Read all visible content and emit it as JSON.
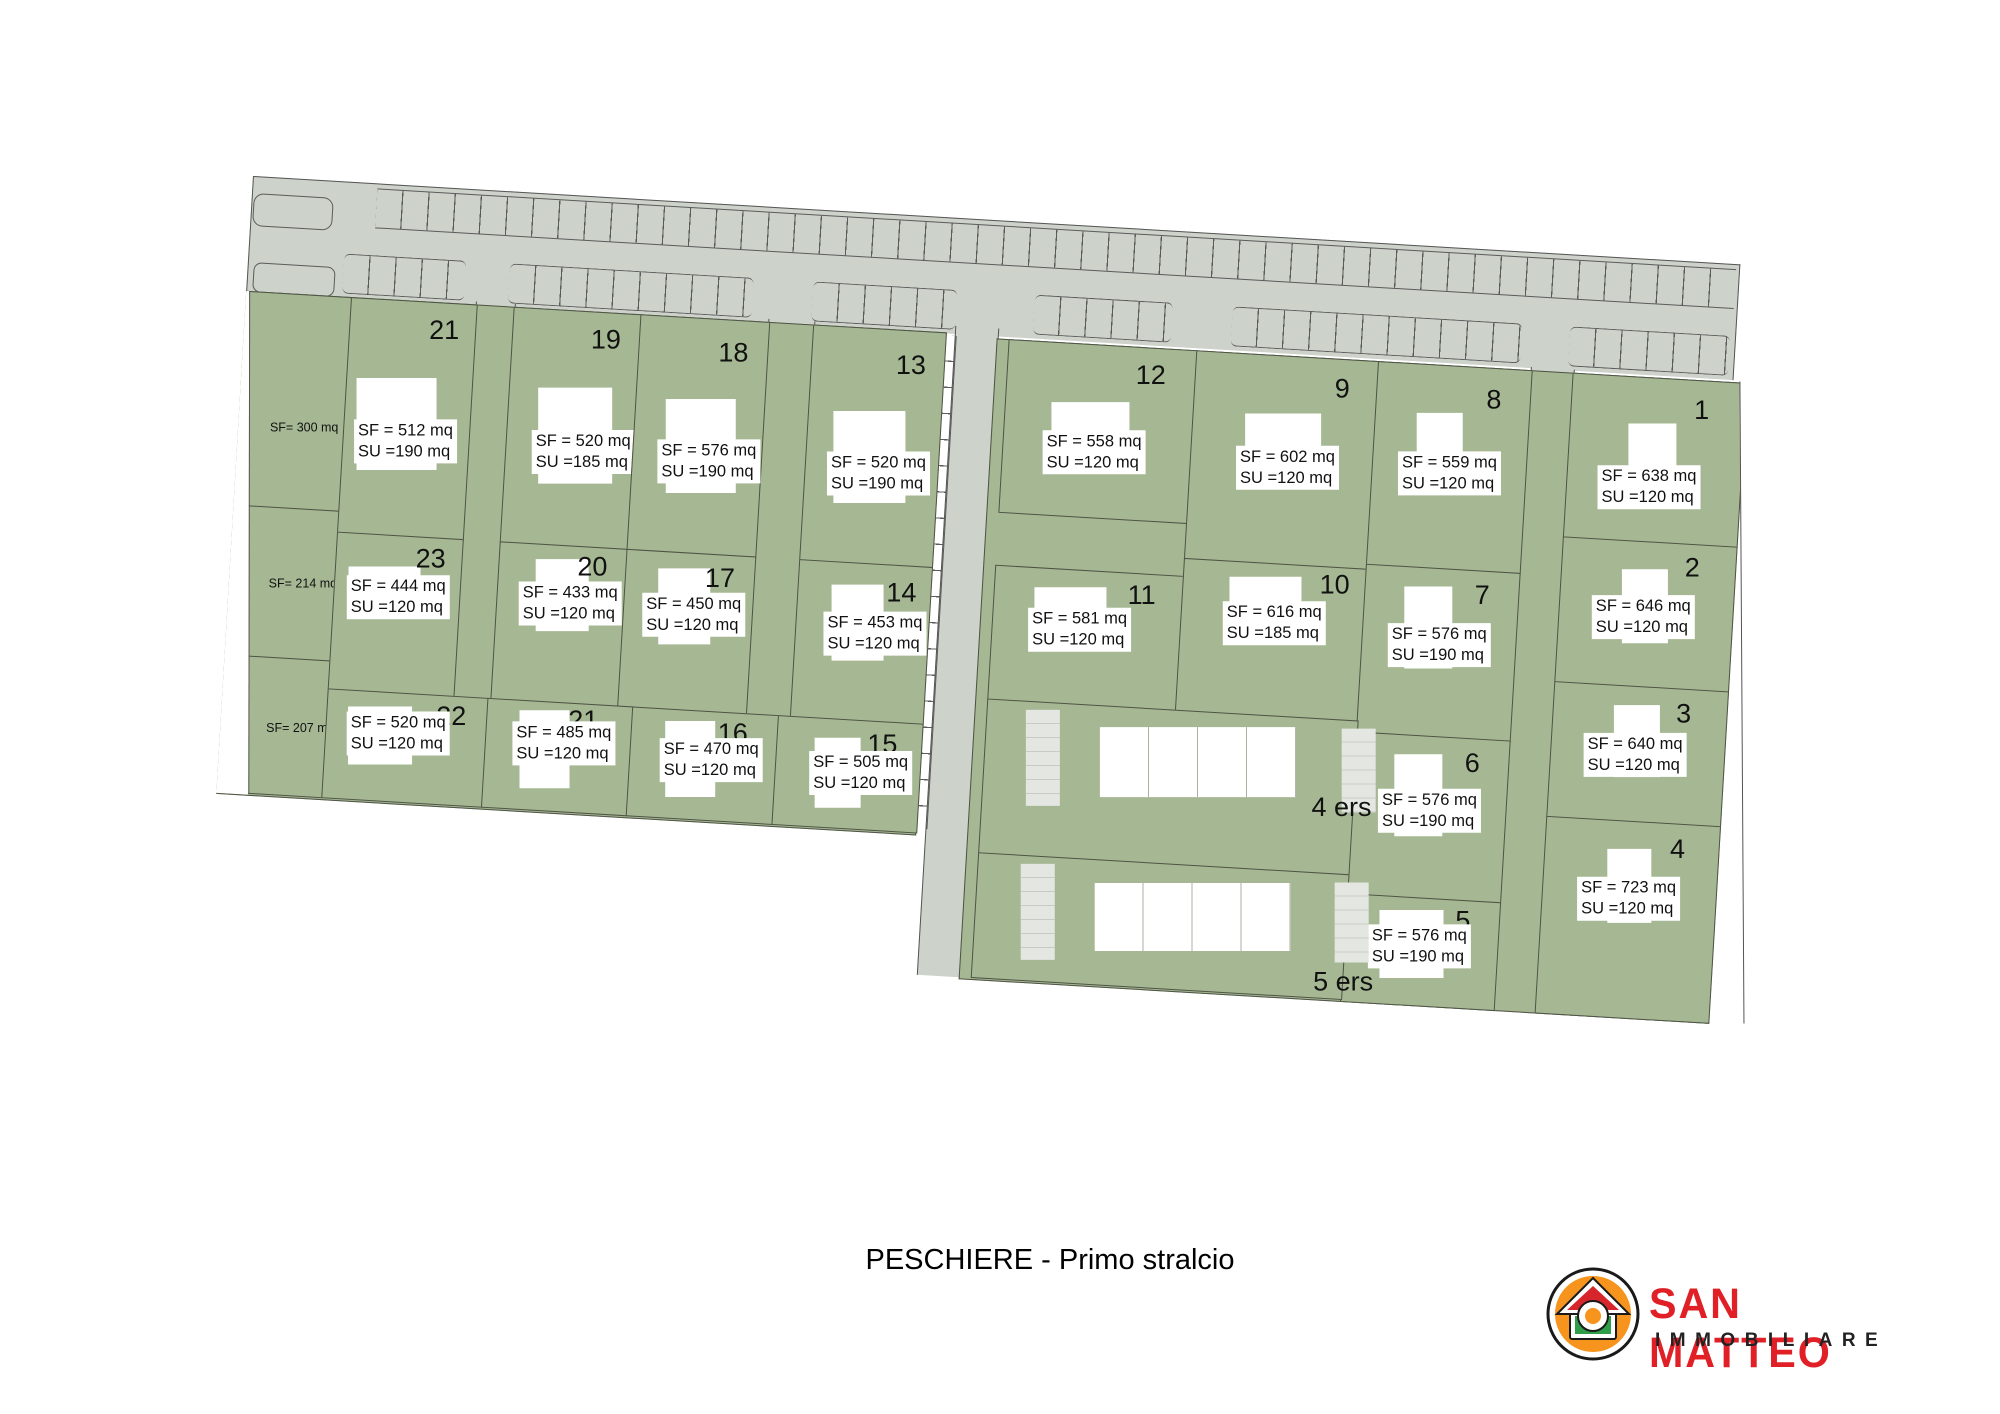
{
  "title": "PESCHIERE - Primo stralcio",
  "logo": {
    "name": "SAN MATTEO",
    "subtitle": "IMMOBILIARE"
  },
  "colors": {
    "lot_green": "#a6b893",
    "road_gray": "#cdd2ca",
    "boundary": "#4e5345",
    "logo_red": "#e01f26",
    "logo_orange": "#f7941e",
    "logo_green": "#2e9e49"
  },
  "plan": {
    "lots": [
      {
        "id": "l21",
        "number": "21",
        "sf": "SF = 512 mq",
        "su": "SU =190 mq"
      },
      {
        "id": "l19",
        "number": "19",
        "sf": "SF = 520 mq",
        "su": "SU =185 mq"
      },
      {
        "id": "l18",
        "number": "18",
        "sf": "SF = 576 mq",
        "su": "SU =190 mq"
      },
      {
        "id": "l13",
        "number": "13",
        "sf": "SF = 520 mq",
        "su": "SU =190 mq"
      },
      {
        "id": "l23",
        "number": "23",
        "sf": "SF = 444 mq",
        "su": "SU =120 mq"
      },
      {
        "id": "l20",
        "number": "20",
        "sf": "SF = 433 mq",
        "su": "SU =120 mq"
      },
      {
        "id": "l17",
        "number": "17",
        "sf": "SF = 450 mq",
        "su": "SU =120 mq"
      },
      {
        "id": "l14",
        "number": "14",
        "sf": "SF = 453 mq",
        "su": "SU =120 mq"
      },
      {
        "id": "l22",
        "number": "22",
        "sf": "SF = 520 mq",
        "su": "SU =120 mq"
      },
      {
        "id": "l21b",
        "number": "21",
        "sf": "SF = 485 mq",
        "su": "SU =120 mq"
      },
      {
        "id": "l16",
        "number": "16",
        "sf": "SF = 470 mq",
        "su": "SU =120 mq"
      },
      {
        "id": "l15",
        "number": "15",
        "sf": "SF = 505 mq",
        "su": "SU =120 mq"
      },
      {
        "id": "l12",
        "number": "12",
        "sf": "SF = 558 mq",
        "su": "SU =120 mq"
      },
      {
        "id": "l9",
        "number": "9",
        "sf": "SF = 602 mq",
        "su": "SU =120 mq"
      },
      {
        "id": "l8",
        "number": "8",
        "sf": "SF = 559 mq",
        "su": "SU =120 mq"
      },
      {
        "id": "l1",
        "number": "1",
        "sf": "SF = 638 mq",
        "su": "SU =120 mq"
      },
      {
        "id": "l11",
        "number": "11",
        "sf": "SF = 581 mq",
        "su": "SU =120 mq"
      },
      {
        "id": "l10",
        "number": "10",
        "sf": "SF = 616 mq",
        "su": "SU =185 mq"
      },
      {
        "id": "l7",
        "number": "7",
        "sf": "SF = 576 mq",
        "su": "SU =190 mq"
      },
      {
        "id": "l2",
        "number": "2",
        "sf": "SF = 646 mq",
        "su": "SU =120 mq"
      },
      {
        "id": "l6",
        "number": "6",
        "sf": "SF = 576 mq",
        "su": "SU =190 mq"
      },
      {
        "id": "l3",
        "number": "3",
        "sf": "SF = 640 mq",
        "su": "SU =120 mq"
      },
      {
        "id": "l5",
        "number": "5",
        "sf": "SF = 576 mq",
        "su": "SU =190 mq"
      },
      {
        "id": "l4",
        "number": "4",
        "sf": "SF = 723 mq",
        "su": "SU =120 mq"
      }
    ],
    "side_plots": [
      {
        "id": "s300",
        "label": "SF= 300 mq"
      },
      {
        "id": "s214",
        "label": "SF= 214 mq"
      },
      {
        "id": "s207",
        "label": "SF= 207 mq"
      }
    ],
    "ers_areas": [
      {
        "id": "ers4",
        "label": "4 ers"
      },
      {
        "id": "ers5",
        "label": "5 ers"
      }
    ]
  }
}
